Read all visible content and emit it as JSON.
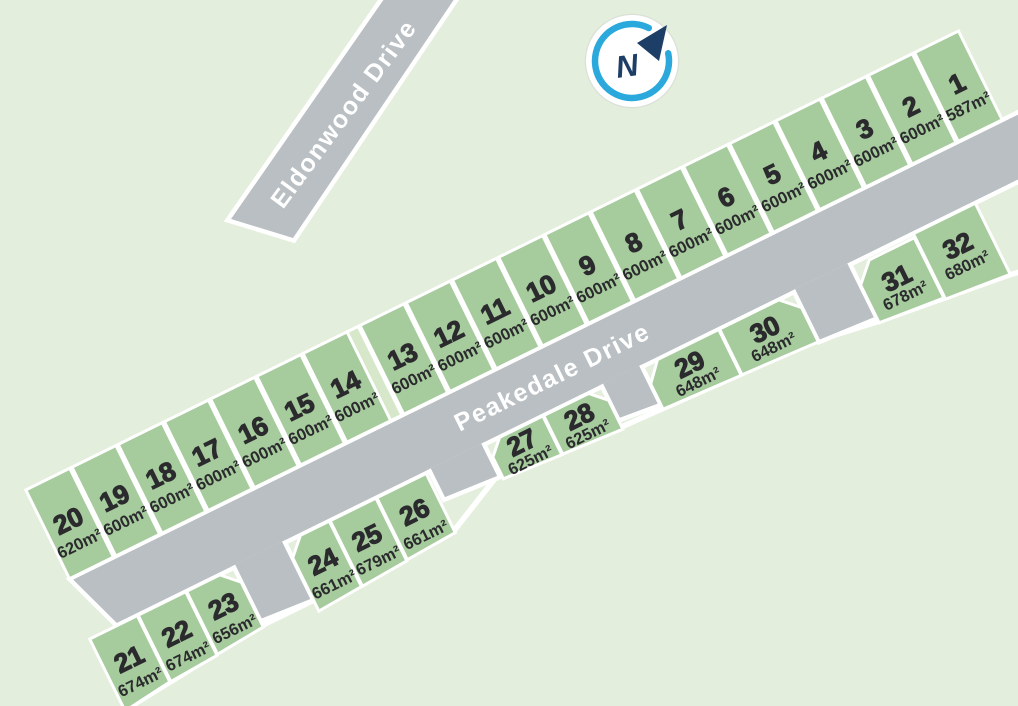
{
  "streets": [
    {
      "name": "Peakedale Drive"
    },
    {
      "name": "Eldonwood Drive"
    }
  ],
  "compass": {
    "label": "N"
  },
  "colors": {
    "background": "#e4eedc",
    "lot_fill": "#a6cb9d",
    "reserve_fill": "#d6e7ca",
    "road_fill": "#b9bfc2",
    "outline": "#ffffff",
    "label_text": "#2b2b2e",
    "street_text": "#ffffff",
    "compass_ring": "#2ba9dc",
    "compass_needle": "#1d3e66"
  },
  "lots": [
    {
      "number": "1",
      "area": "587m²"
    },
    {
      "number": "2",
      "area": "600m²"
    },
    {
      "number": "3",
      "area": "600m²"
    },
    {
      "number": "4",
      "area": "600m²"
    },
    {
      "number": "5",
      "area": "600m²"
    },
    {
      "number": "6",
      "area": "600m²"
    },
    {
      "number": "7",
      "area": "600m²"
    },
    {
      "number": "8",
      "area": "600m²"
    },
    {
      "number": "9",
      "area": "600m²"
    },
    {
      "number": "10",
      "area": "600m²"
    },
    {
      "number": "11",
      "area": "600m²"
    },
    {
      "number": "12",
      "area": "600m²"
    },
    {
      "number": "13",
      "area": "600m²"
    },
    {
      "number": "14",
      "area": "600m²"
    },
    {
      "number": "15",
      "area": "600m²"
    },
    {
      "number": "16",
      "area": "600m²"
    },
    {
      "number": "17",
      "area": "600m²"
    },
    {
      "number": "18",
      "area": "600m²"
    },
    {
      "number": "19",
      "area": "600m²"
    },
    {
      "number": "20",
      "area": "620m²"
    },
    {
      "number": "21",
      "area": "674m²"
    },
    {
      "number": "22",
      "area": "674m²"
    },
    {
      "number": "23",
      "area": "656m²"
    },
    {
      "number": "24",
      "area": "661m²"
    },
    {
      "number": "25",
      "area": "679m²"
    },
    {
      "number": "26",
      "area": "661m²"
    },
    {
      "number": "27",
      "area": "625m²"
    },
    {
      "number": "28",
      "area": "625m²"
    },
    {
      "number": "29",
      "area": "648m²"
    },
    {
      "number": "30",
      "area": "648m²"
    },
    {
      "number": "31",
      "area": "678m²"
    },
    {
      "number": "32",
      "area": "680m²"
    }
  ]
}
